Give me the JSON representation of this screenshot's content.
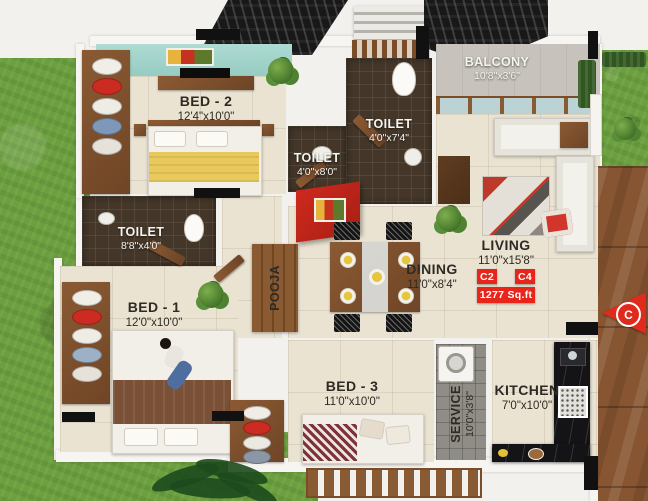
{
  "title": "apartment-floor-plan",
  "rooms": {
    "bed2": {
      "label": "BED - 2",
      "dims": "12'4\"x10'0\""
    },
    "toilet_top": {
      "label": "TOILET",
      "dims": "4'0\"x7'4\""
    },
    "toilet_mid": {
      "label": "TOILET",
      "dims": "4'0\"x8'0\""
    },
    "balcony": {
      "label": "BALCONY",
      "dims": "10'8\"x3'6\""
    },
    "toilet_left": {
      "label": "TOILET",
      "dims": "8'8\"x4'0\""
    },
    "bed1": {
      "label": "BED - 1",
      "dims": "12'0\"x10'0\""
    },
    "pooja": {
      "label": "POOJA"
    },
    "dining": {
      "label": "DINING",
      "dims": "11'0\"x8'4\""
    },
    "living": {
      "label": "LIVING",
      "dims": "11'0\"x15'8\""
    },
    "bed3": {
      "label": "BED - 3",
      "dims": "11'0\"x10'0\""
    },
    "service": {
      "label": "SERVICE",
      "dims": "10'0\"x3'8\""
    },
    "kitchen": {
      "label": "KITCHEN",
      "dims": "7'0\"x10'0\""
    }
  },
  "unit": {
    "type_a": "C2",
    "type_b": "C4",
    "area": "1277 Sq.ft"
  },
  "entry": {
    "marker": "C"
  },
  "colors": {
    "accent_red": "#e02a1c",
    "teal_ceiling": "#a2d4cb",
    "grass": "#6c9f3e",
    "wood": "#8a5a33",
    "floor_cream": "#ebe3d2",
    "toilet_tile": "#443729",
    "marble_black": "#141416"
  }
}
